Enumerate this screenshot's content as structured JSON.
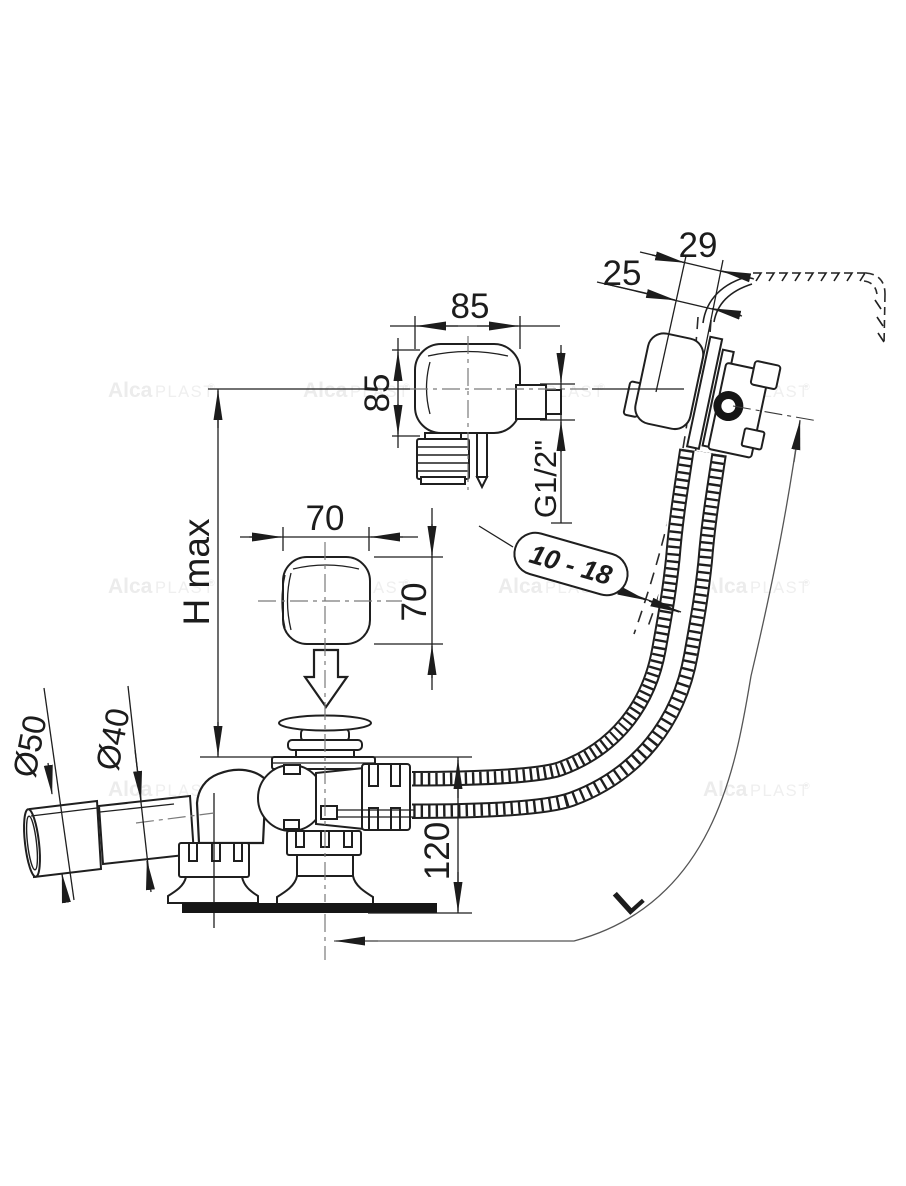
{
  "title": "Bath waste and overflow set - technical dimension drawing",
  "brand_watermark": {
    "alca": "Alca",
    "plast": "PLAST",
    "reg": "®"
  },
  "colors": {
    "line": "#1f1f1f",
    "centerline": "#7a7a7a",
    "watermark": "#ececec",
    "background": "#ffffff"
  },
  "dimensions": {
    "rim_offset_outer": "29",
    "rim_offset_inner": "25",
    "overflow_width": "85",
    "overflow_height": "85",
    "thread": "G1/2\"",
    "wall_thickness_range": "10 - 18",
    "knob_width": "70",
    "knob_height": "70",
    "h_max": "H max",
    "outlet_outer_dia": "Ø50",
    "outlet_inner_dia": "Ø40",
    "drain_height": "120",
    "hose_length": "L"
  }
}
